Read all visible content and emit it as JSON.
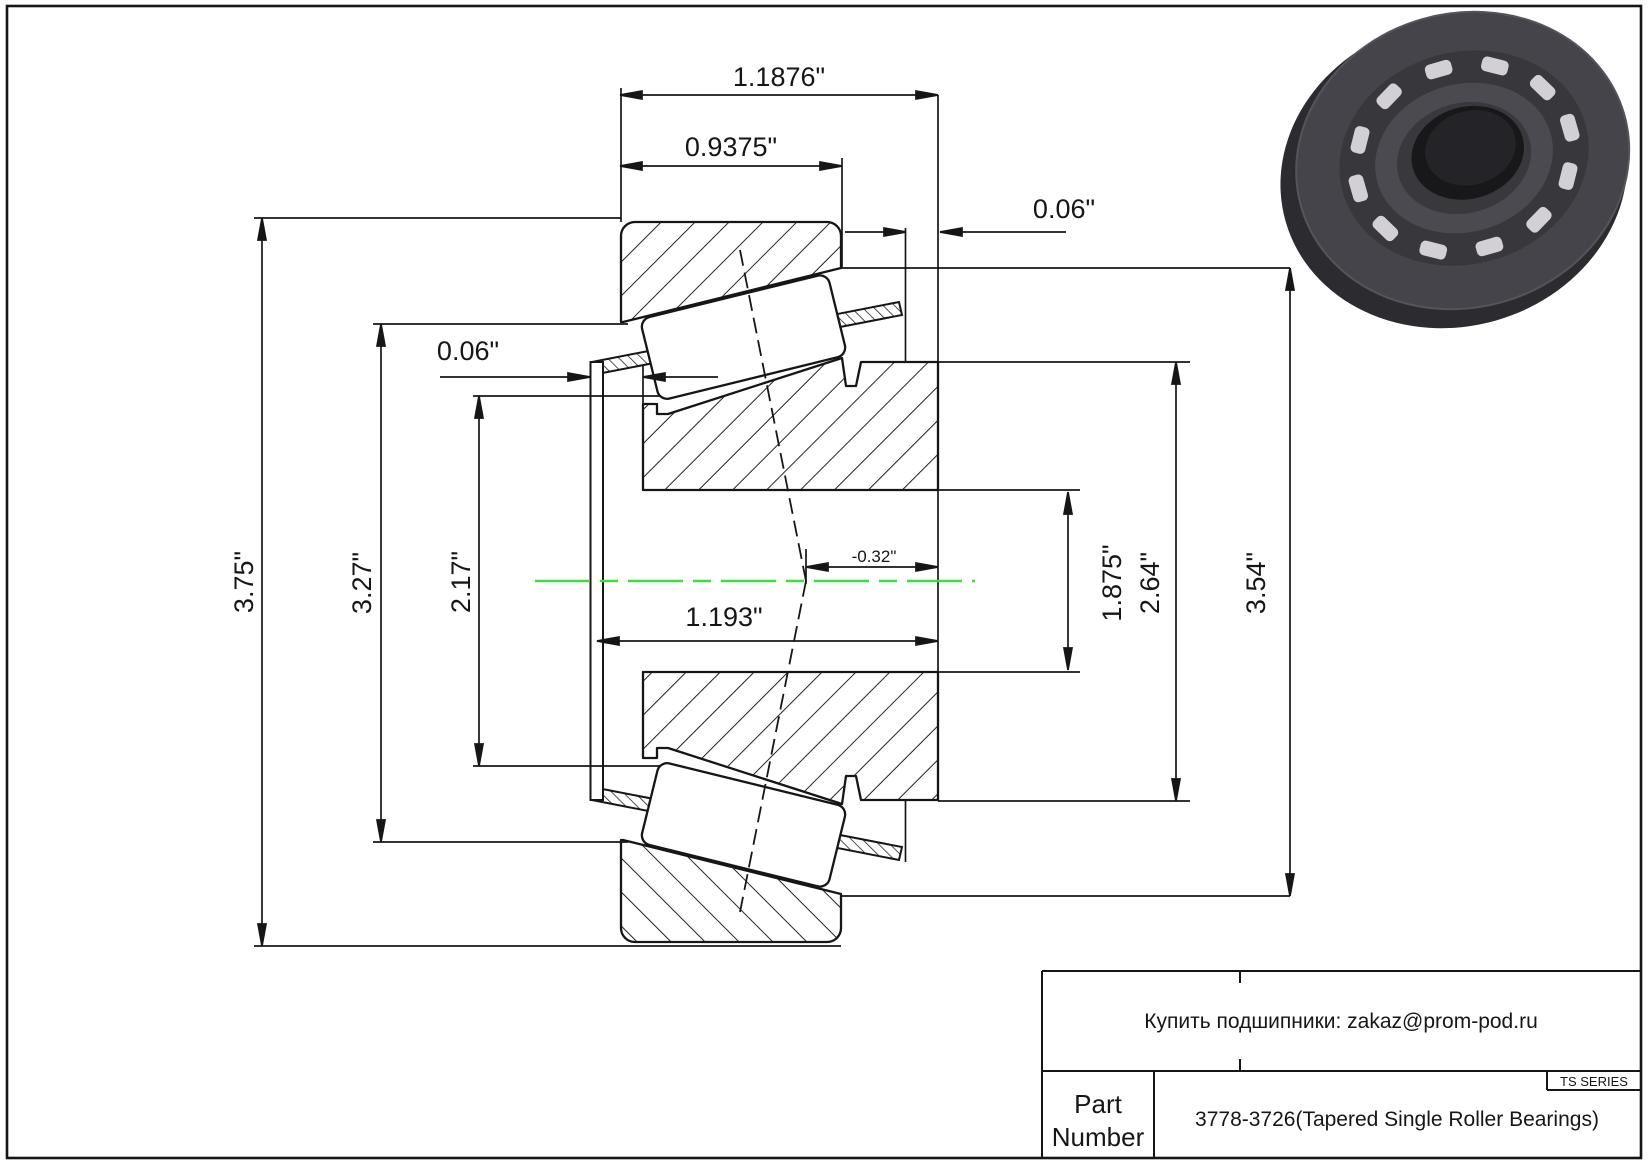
{
  "dims": {
    "overall_width": "1.1876\"",
    "cup_width": "0.9375\"",
    "back_gap": "0.06\"",
    "front_gap": "0.06\"",
    "flange_od": "3.75\"",
    "cup_inner": "3.27\"",
    "race_small": "2.17\"",
    "cone_width": "1.193\"",
    "center_offset": "-0.32\"",
    "bore": "1.875\"",
    "rib_od": "2.64\"",
    "outer_od": "3.54\""
  },
  "title_block": {
    "note": "Купить подшипники: zakaz@prom-pod.ru",
    "part_label_line1": "Part",
    "part_label_line2": "Number",
    "part_number": "3778-3726(Tapered Single Roller Bearings)",
    "series": "TS SERIES"
  },
  "colors": {
    "line": "#161616",
    "centerline_green": "#3adf3a",
    "bearing_dark": "#323136",
    "roller_light": "#d2d0d5"
  }
}
